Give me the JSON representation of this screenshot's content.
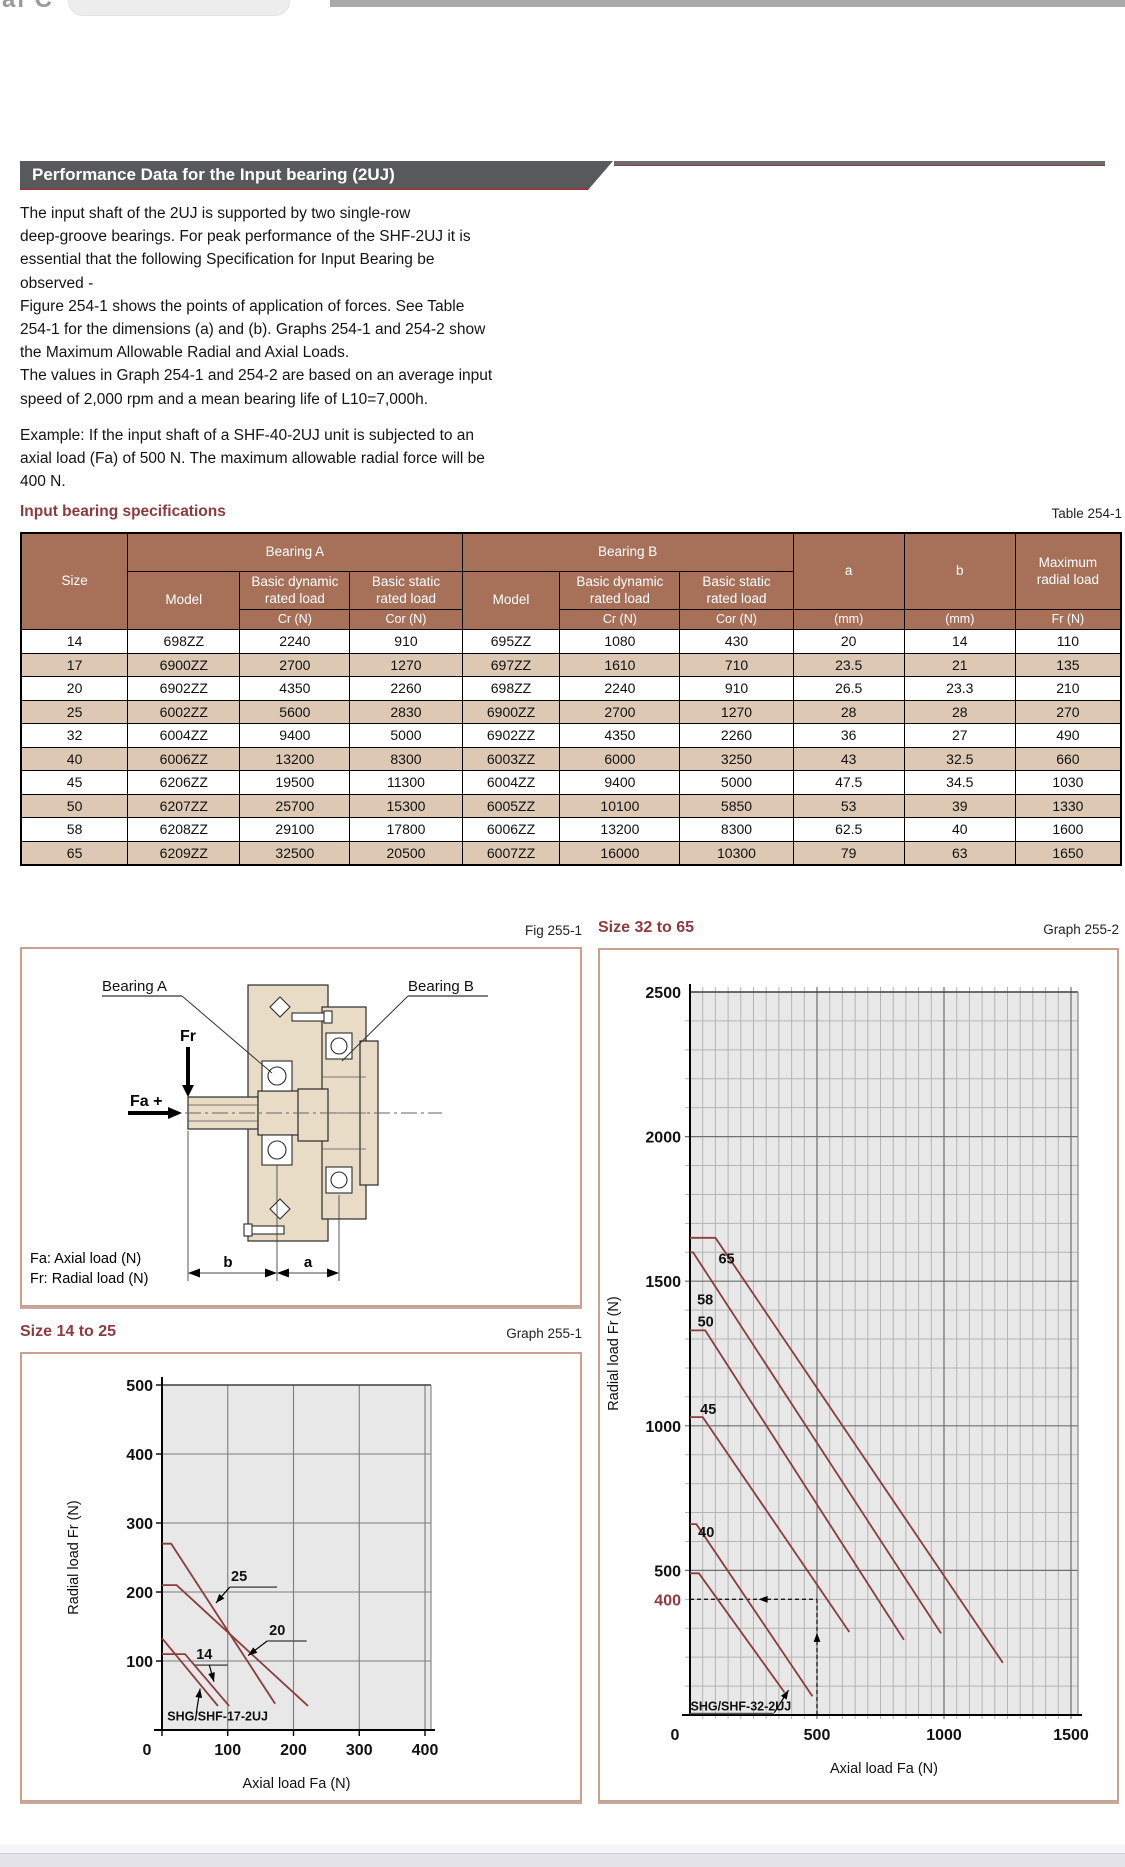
{
  "chrome": {
    "fragment_text": "al C"
  },
  "banner": {
    "title": "Performance Data for the Input bearing (2UJ)"
  },
  "intro": {
    "p1": "The input shaft of the 2UJ is supported by two single-row\ndeep-groove bearings. For peak performance of the SHF-2UJ it is\nessential that the following Specification for Input Bearing be\nobserved -\nFigure 254-1 shows the points of application of forces. See Table\n254-1 for the dimensions (a) and (b). Graphs 254-1 and 254-2 show\nthe Maximum Allowable Radial and Axial Loads.\nThe values in Graph 254-1 and 254-2 are based on an average input\nspeed of 2,000 rpm and a mean bearing life of L10=7,000h.",
    "p2": "Example: If the input shaft of a SHF-40-2UJ unit is subjected to an\naxial load (Fa) of 500 N. The maximum allowable radial force will be\n400 N."
  },
  "table": {
    "section_title": "Input bearing specifications",
    "table_label": "Table 254-1",
    "header": {
      "size": "Size",
      "bearing_a": "Bearing A",
      "bearing_b": "Bearing B",
      "model": "Model",
      "basic_dynamic": "Basic dynamic\nrated load",
      "basic_static": "Basic static\nrated load",
      "cr": "Cr (N)",
      "cor": "Cor (N)",
      "a": "a",
      "b": "b",
      "mm": "(mm)",
      "max_radial": "Maximum\nradial load",
      "fr": "Fr (N)"
    },
    "rows": [
      [
        "14",
        "698ZZ",
        "2240",
        "910",
        "695ZZ",
        "1080",
        "430",
        "20",
        "14",
        "110"
      ],
      [
        "17",
        "6900ZZ",
        "2700",
        "1270",
        "697ZZ",
        "1610",
        "710",
        "23.5",
        "21",
        "135"
      ],
      [
        "20",
        "6902ZZ",
        "4350",
        "2260",
        "698ZZ",
        "2240",
        "910",
        "26.5",
        "23.3",
        "210"
      ],
      [
        "25",
        "6002ZZ",
        "5600",
        "2830",
        "6900ZZ",
        "2700",
        "1270",
        "28",
        "28",
        "270"
      ],
      [
        "32",
        "6004ZZ",
        "9400",
        "5000",
        "6902ZZ",
        "4350",
        "2260",
        "36",
        "27",
        "490"
      ],
      [
        "40",
        "6006ZZ",
        "13200",
        "8300",
        "6003ZZ",
        "6000",
        "3250",
        "43",
        "32.5",
        "660"
      ],
      [
        "45",
        "6206ZZ",
        "19500",
        "11300",
        "6004ZZ",
        "9400",
        "5000",
        "47.5",
        "34.5",
        "1030"
      ],
      [
        "50",
        "6207ZZ",
        "25700",
        "15300",
        "6005ZZ",
        "10100",
        "5850",
        "53",
        "39",
        "1330"
      ],
      [
        "58",
        "6208ZZ",
        "29100",
        "17800",
        "6006ZZ",
        "13200",
        "8300",
        "62.5",
        "40",
        "1600"
      ],
      [
        "65",
        "6209ZZ",
        "32500",
        "20500",
        "6007ZZ",
        "16000",
        "10300",
        "79",
        "63",
        "1650"
      ]
    ]
  },
  "figure": {
    "fig_label": "Fig 255-1",
    "bearing_a_label": "Bearing A",
    "bearing_b_label": "Bearing B",
    "fr_label": "Fr",
    "fa_label": "Fa +",
    "dim_b": "b",
    "dim_a": "a",
    "caption_fa": "Fa: Axial load (N)",
    "caption_fr": "Fr: Radial load (N)"
  },
  "chart_data": [
    {
      "type": "line",
      "title": "Size 14 to 25",
      "graph_label": "Graph 255-1",
      "xlabel": "Axial load Fa (N)",
      "ylabel": "Radial load Fr (N)",
      "xlim": [
        0,
        409
      ],
      "ylim": [
        0,
        500
      ],
      "x_ticks": [
        100,
        200,
        300,
        400
      ],
      "y_ticks": [
        100,
        200,
        300,
        400,
        500
      ],
      "origin_label": "0",
      "grid": "major-only",
      "legend_position": "none",
      "series": [
        {
          "name": "14",
          "points": [
            [
              0,
              110
            ],
            [
              35,
              110
            ],
            [
              102,
              35
            ]
          ]
        },
        {
          "name": "17",
          "points": [
            [
              0,
              133
            ],
            [
              85,
              35
            ]
          ]
        },
        {
          "name": "20",
          "points": [
            [
              0,
              210
            ],
            [
              22,
              210
            ],
            [
              222,
              35
            ]
          ]
        },
        {
          "name": "25",
          "points": [
            [
              0,
              270
            ],
            [
              14,
              270
            ],
            [
              172,
              38
            ]
          ]
        }
      ],
      "annotations": [
        {
          "text": "25",
          "x": 105,
          "y": 216,
          "underline": [
            103,
            175,
            207
          ],
          "arrow": [
            [
              103,
              207
            ],
            [
              82,
              184
            ]
          ]
        },
        {
          "text": "20",
          "x": 163,
          "y": 138,
          "underline": [
            160,
            220,
            129
          ],
          "arrow": [
            [
              160,
              129
            ],
            [
              131,
              108
            ]
          ]
        },
        {
          "text": "14",
          "x": 52,
          "y": 103,
          "underline": [
            50,
            100,
            94
          ],
          "arrow": [
            [
              72,
              94
            ],
            [
              79,
              70
            ]
          ]
        },
        {
          "text": "SHG/SHF-17-2UJ",
          "x": 8,
          "y": 14,
          "small": true,
          "arrow": [
            [
              52,
              24
            ],
            [
              58,
              60
            ]
          ]
        }
      ]
    },
    {
      "type": "line",
      "title": "Size 32 to 65",
      "graph_label": "Graph 255-2",
      "xlabel": "Axial load Fa (N)",
      "ylabel": "Radial load Fr (N)",
      "xlim": [
        0,
        1527
      ],
      "ylim": [
        0,
        2500
      ],
      "x_ticks": [
        500,
        1000,
        1500
      ],
      "y_ticks": [
        500,
        1000,
        1500,
        2000,
        2500
      ],
      "origin_label": "0",
      "grid": "minor",
      "minor_x": 50,
      "minor_y": 100,
      "major_x": 500,
      "major_y": 500,
      "extra_y_label": {
        "value": 400,
        "text": "400"
      },
      "dashed_example": {
        "fa": 500,
        "fr": 400
      },
      "legend_position": "none",
      "series": [
        {
          "name": "32",
          "points": [
            [
              0,
              490
            ],
            [
              35,
              490
            ],
            [
              372,
              78
            ]
          ]
        },
        {
          "name": "40",
          "points": [
            [
              0,
              660
            ],
            [
              25,
              660
            ],
            [
              482,
              65
            ]
          ]
        },
        {
          "name": "45",
          "points": [
            [
              0,
              1030
            ],
            [
              50,
              1030
            ],
            [
              627,
              287
            ]
          ]
        },
        {
          "name": "50",
          "points": [
            [
              0,
              1330
            ],
            [
              60,
              1330
            ],
            [
              842,
              260
            ]
          ]
        },
        {
          "name": "58",
          "points": [
            [
              0,
              1600
            ],
            [
              12,
              1600
            ],
            [
              988,
              282
            ]
          ]
        },
        {
          "name": "65",
          "points": [
            [
              0,
              1650
            ],
            [
              100,
              1650
            ],
            [
              1232,
              180
            ]
          ]
        }
      ],
      "annotations": [
        {
          "text": "65",
          "x": 112,
          "y": 1562
        },
        {
          "text": "58",
          "x": 28,
          "y": 1420
        },
        {
          "text": "50",
          "x": 30,
          "y": 1343
        },
        {
          "text": "45",
          "x": 40,
          "y": 1040
        },
        {
          "text": "40",
          "x": 32,
          "y": 615
        },
        {
          "text": "SHG/SHF-32-2UJ",
          "x": 2,
          "y": 16,
          "small": true,
          "underline": [
            0,
            330,
            5
          ],
          "arrow": [
            [
              332,
              8
            ],
            [
              388,
              86
            ]
          ]
        }
      ]
    }
  ]
}
